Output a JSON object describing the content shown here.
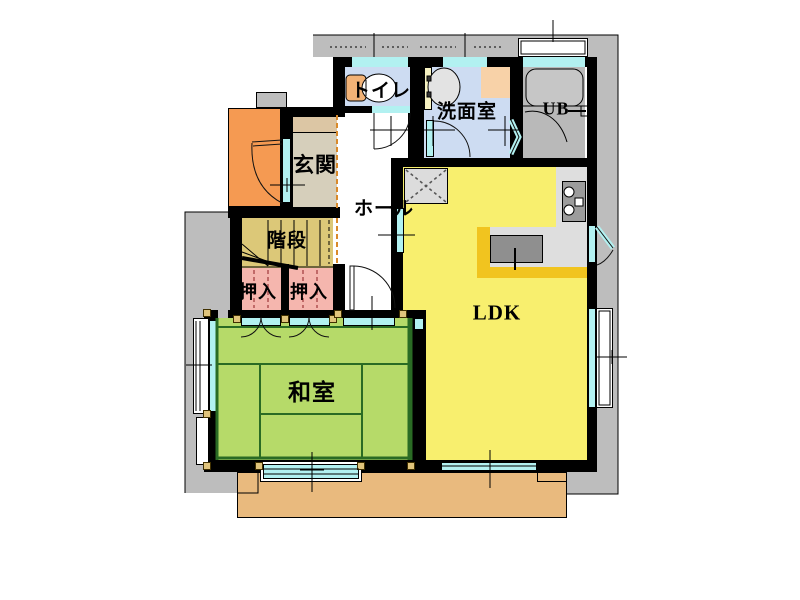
{
  "rooms": {
    "toilet": {
      "label": "トイレ"
    },
    "washroom": {
      "label": "洗面室"
    },
    "unit_bath": {
      "label": "UB"
    },
    "entrance": {
      "label": "玄関"
    },
    "hall": {
      "label": "ホール"
    },
    "stairs": {
      "label": "階段"
    },
    "closet_left": {
      "label": "押入"
    },
    "closet_right": {
      "label": "押入"
    },
    "japanese_room": {
      "label": "和室"
    },
    "ldk": {
      "label": "LDK"
    }
  },
  "colors": {
    "site_gray": "#bdbdbd",
    "wall_black": "#000000",
    "window_cyan": "#b2f1f1",
    "water_room_blue": "#cddcf2",
    "unit_bath_gray": "#b9b9b9",
    "entrance_tan": "#d6cfbb",
    "stairs_khaki": "#dcc878",
    "closet_pink": "#f5b6ae",
    "tatami_green": "#b6da69",
    "tatami_edge_green": "#2a6b24",
    "ldk_yellow": "#f8ef6e",
    "porch_orange": "#f59a52",
    "deck_tan": "#e9ba7e",
    "counter_gold": "#f1c41f",
    "kitchen_gray": "#dedede",
    "corner_post_tan": "#e0c47c"
  }
}
